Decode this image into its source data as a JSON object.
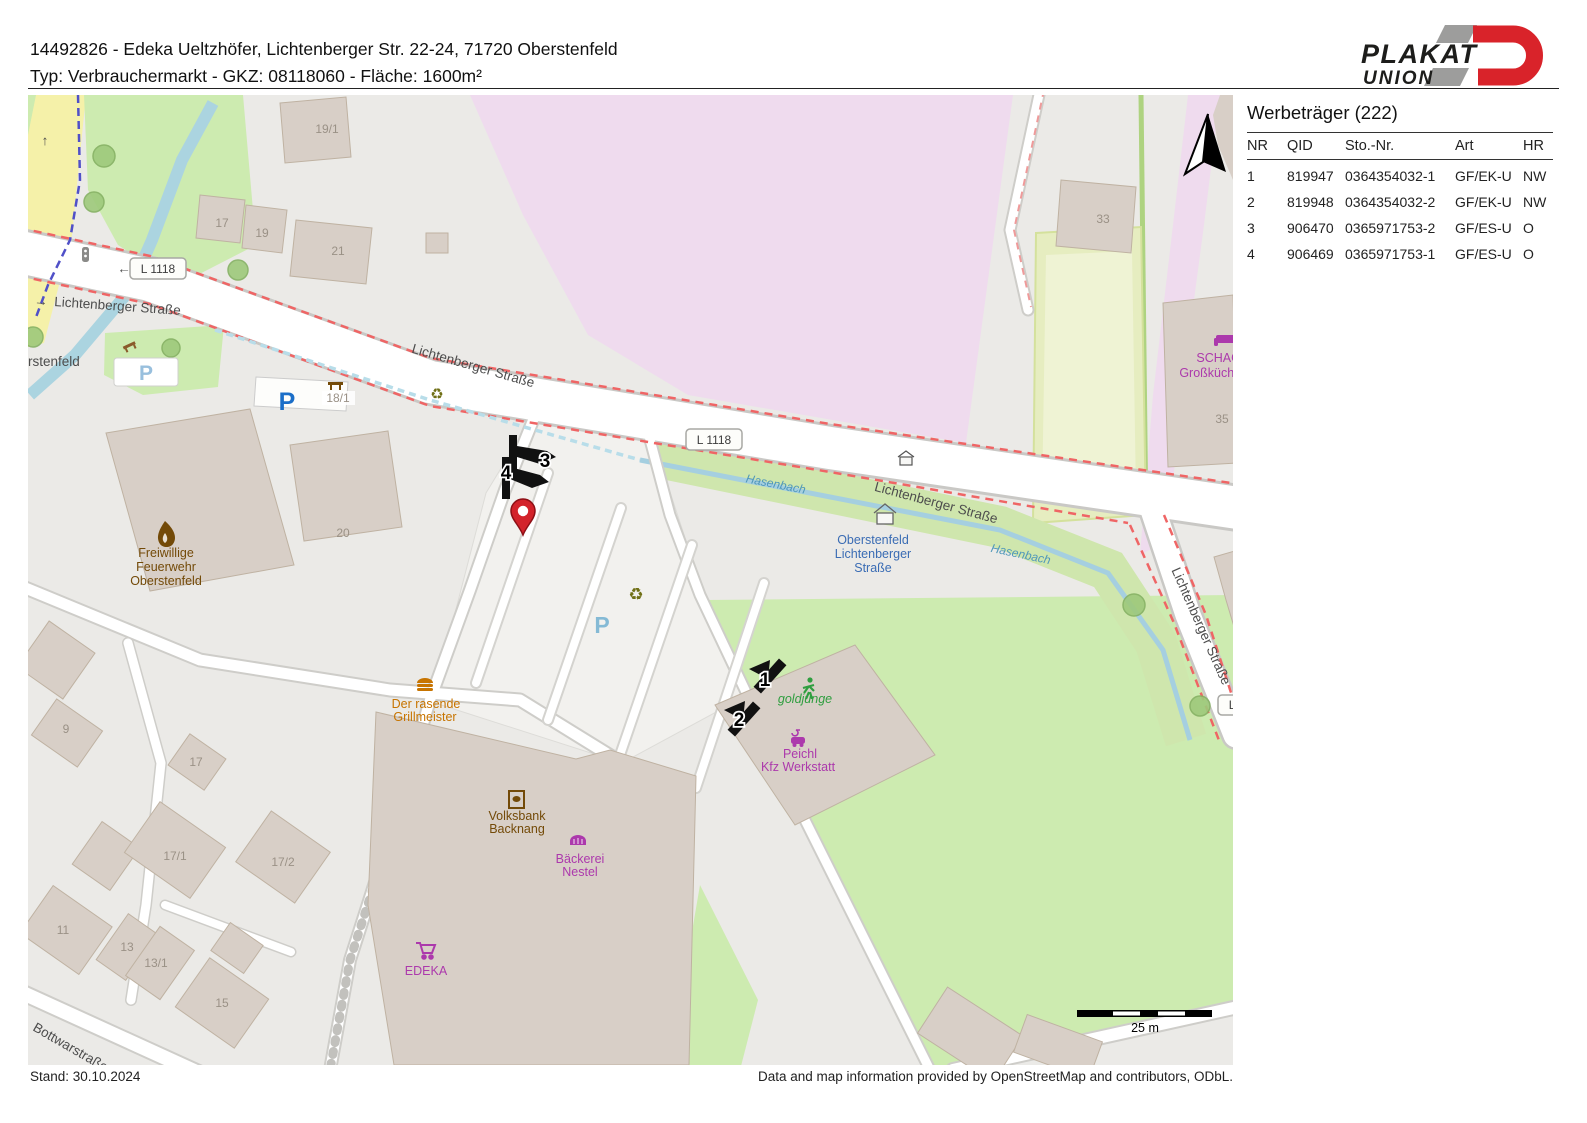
{
  "header": {
    "line1": "14492826 - Edeka Ueltzhöfer, Lichtenberger Str. 22-24, 71720 Oberstenfeld",
    "line2": "Typ: Verbrauchermarkt - GKZ: 08118060 - Fläche: 1600m²"
  },
  "logo": {
    "word1": "PLAKAT",
    "word2": "UNION"
  },
  "panel": {
    "title": "Werbeträger (222)",
    "columns": [
      "NR",
      "QID",
      "Sto.-Nr.",
      "Art",
      "HR"
    ],
    "rows": [
      [
        "1",
        "819947",
        "0364354032-1",
        "GF/EK-U",
        "NW"
      ],
      [
        "2",
        "819948",
        "0364354032-2",
        "GF/EK-U",
        "NW"
      ],
      [
        "3",
        "906470",
        "0365971753-2",
        "GF/ES-U",
        "O"
      ],
      [
        "4",
        "906469",
        "0365971753-1",
        "GF/ES-U",
        "O"
      ]
    ]
  },
  "footer": {
    "stand": "Stand: 30.10.2024",
    "credit": "Data and map information provided by OpenStreetMap and contributors, ODbL."
  },
  "map": {
    "streets": {
      "lichtenberger": "Lichtenberger Straße",
      "bottwar": "Bottwarstraße",
      "ref": "L 1118"
    },
    "water": {
      "hasenbach": "Hasenbach"
    },
    "place_partial": "rstenfeld",
    "bus_stop": {
      "line1": "Oberstenfeld",
      "line2": "Lichtenberger",
      "line3": "Straße"
    },
    "pois": {
      "feuerwehr": [
        "Freiwillige",
        "Feuerwehr",
        "Oberstenfeld"
      ],
      "grillmeister": [
        "Der rasende",
        "Grillmeister"
      ],
      "volksbank": [
        "Volksbank",
        "Backnang"
      ],
      "baeckerei": [
        "Bäckerei",
        "Nestel"
      ],
      "edeka": "EDEKA",
      "goldjunge": "goldjunge",
      "peichl": [
        "Peichl",
        "Kfz Werkstatt"
      ],
      "schagro": [
        "SCHAGRO",
        "Großküchente-"
      ]
    },
    "housenumbers": [
      "19/1",
      "17",
      "19",
      "21",
      "18/1",
      "20",
      "33",
      "35",
      "9",
      "17",
      "17/1",
      "17/2",
      "11",
      "13",
      "13/1",
      "15"
    ],
    "parking_letter": "P",
    "markers": [
      "1",
      "2",
      "3",
      "4"
    ],
    "scale_label": "25 m",
    "glyphs": {
      "arrow_left": "←",
      "arrow_right": "→",
      "arrow_up": "↑",
      "recycle": "♻"
    },
    "colors": {
      "route_red": "#ef6565",
      "water_blue": "#a5cfe0",
      "grass_green": "#cdebb0",
      "commercial_pink": "#efdbee",
      "building_beige": "#d8cfc7",
      "brand_red": "#d9232a",
      "marker_black": "#111111",
      "pin_red": "#d3232b"
    }
  }
}
